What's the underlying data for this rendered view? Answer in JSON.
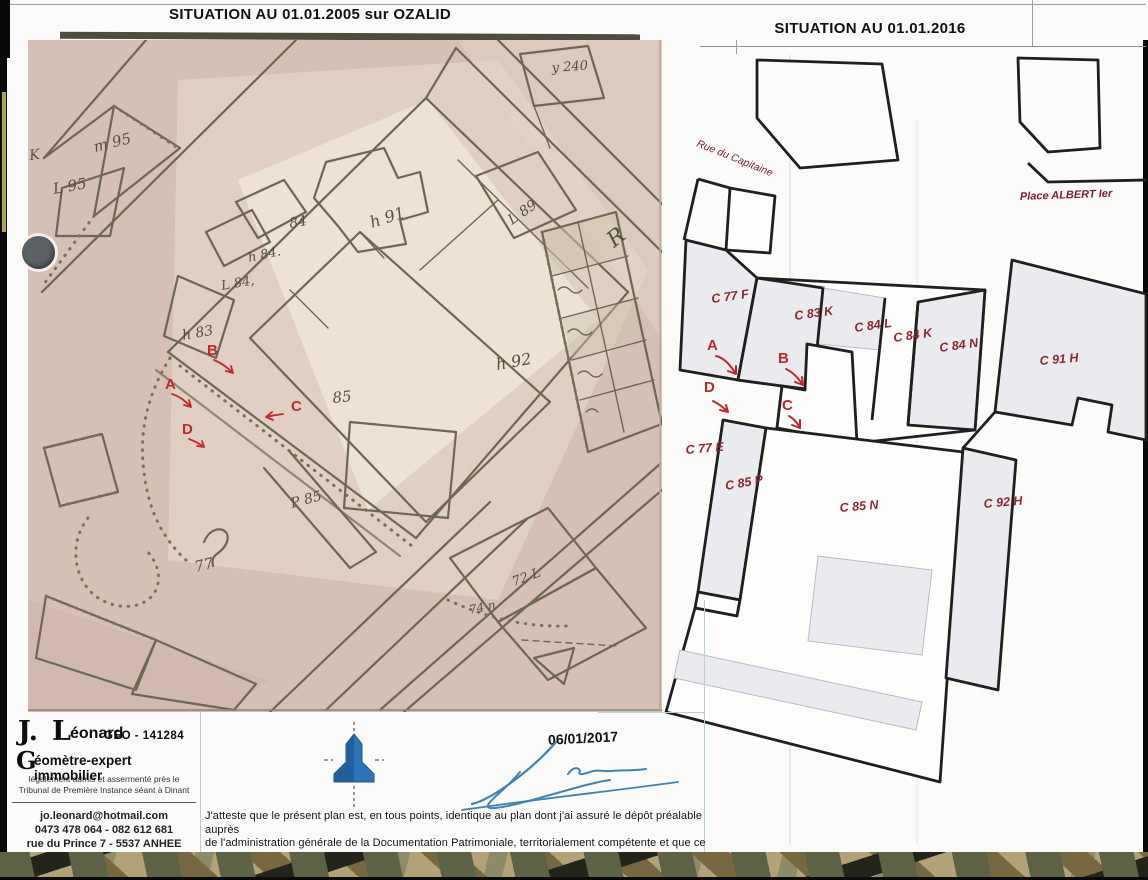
{
  "titles": {
    "left": "SITUATION AU 01.01.2005 sur OZALID",
    "right": "SITUATION AU 01.01.2016"
  },
  "right_map": {
    "streets": {
      "rue": "Rue du Capitaine",
      "place": "Place ALBERT Ier"
    },
    "parcels": {
      "c77f": "C 77 F",
      "c83k": "C 83 K",
      "c84l": "C 84 L",
      "c84k": "C 84 K",
      "c84n": "C 84 N",
      "c91h": "C 91 H",
      "c77e": "C 77 E",
      "c85p": "C 85 P",
      "c85n": "C 85 N",
      "c92h": "C 92 H"
    },
    "markers": {
      "a": "A",
      "b": "B",
      "c": "C",
      "d": "D"
    }
  },
  "left_map": {
    "markers": {
      "a": "A",
      "b": "B",
      "c": "C",
      "d": "D"
    },
    "labels": {
      "k": "K",
      "m95": "m 95",
      "l95": "L 95",
      "y240": "y 240",
      "n84": "84",
      "h84": "h 84.",
      "l84": "L 84,",
      "h83": "h 83",
      "h91": "h 91",
      "l89": "L 89",
      "h92": "h 92",
      "n85": "85",
      "p85": "P 85",
      "n77": "77",
      "n72": "72 L",
      "n74": "74 n",
      "r": "R"
    }
  },
  "footer": {
    "name_initial_j": "J.",
    "name_initial_l": "L",
    "name_rest": "éonard",
    "geo_ref": "GEO - 141284",
    "prof_initial": "G",
    "prof_rest": "éomètre-expert immobilier",
    "accred1": "légalement admis et assermenté près le",
    "accred2": "Tribunal de Première Instance séant à Dinant",
    "email": "jo.leonard@hotmail.com",
    "phone": "0473 478 064 - 082 612 681",
    "address": "rue du Prince 7 - 5537 ANHEE",
    "date": "06/01/2017",
    "att1": "J'atteste que le présent plan est, en tous points, identique au plan dont j'ai assuré le dépôt préalable auprès",
    "att2": "de l'administration générale de la Documentation Patrimoniale, territorialement compétente et que ce plan a",
    "att3": "reçu la référence",
    "reference": "52 049  ′ 10·199",
    "att4": ". et qu'il n'a pas subi de modification depuis ce dépôt."
  }
}
